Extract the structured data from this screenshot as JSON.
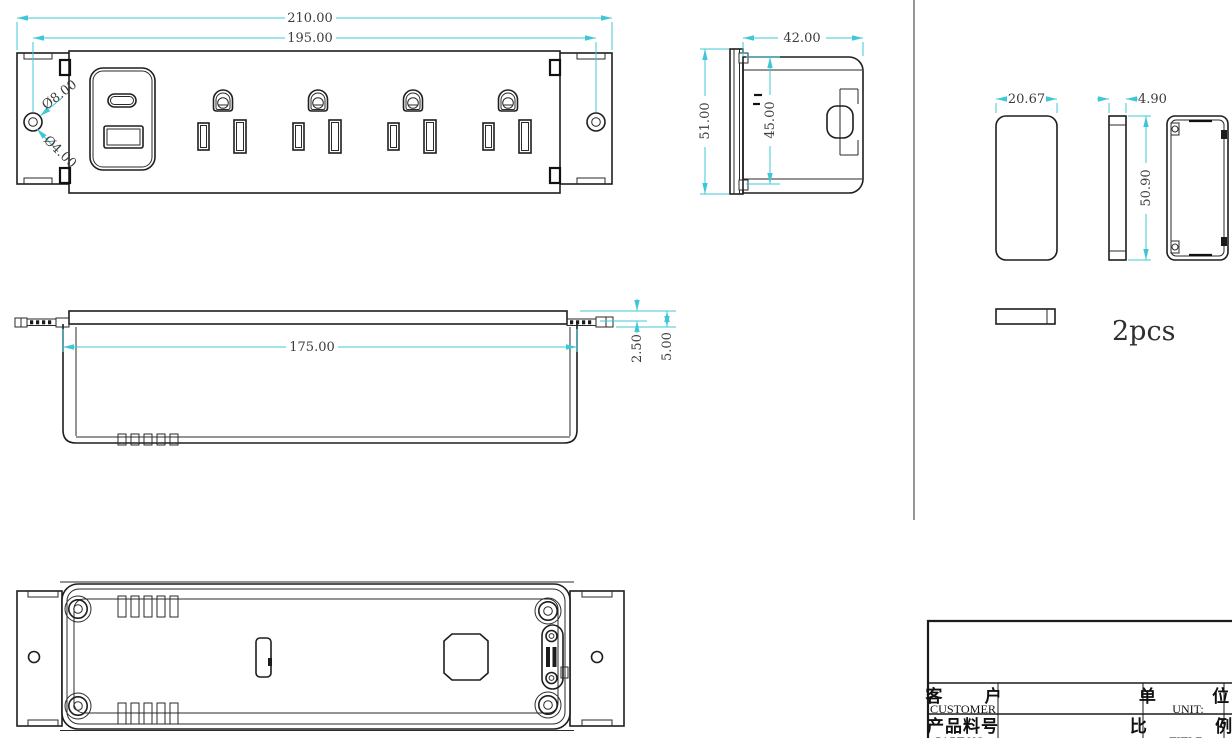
{
  "dimensions": {
    "front": {
      "overall_width": "210.00",
      "hole_spacing": "195.00",
      "hole_outer_dia": "Ø8.00",
      "hole_inner_dia": "Ø4.00"
    },
    "side": {
      "depth": "42.00",
      "height": "51.00",
      "inner_height": "45.00"
    },
    "profile": {
      "inner_length": "175.00",
      "plate_lip": "2.50",
      "plate_offset": "5.00"
    },
    "endcap": {
      "width": "20.67",
      "thickness": "4.90",
      "height": "50.90",
      "quantity": "2pcs"
    }
  },
  "title_block": {
    "customer_label_cn": "客 户",
    "customer_label_en": "CUSTOMER",
    "part_no_label_cn": "产品料号",
    "part_no_label_en": "PART NO",
    "unit_label_cn": "单 位",
    "unit_label_en": "UNIT:",
    "scale_label_cn": "比 例",
    "scale_label_en": "TITLE"
  },
  "colors": {
    "dimension_line": "#3fc7d7",
    "geometry_line": "#1e1e1e"
  }
}
